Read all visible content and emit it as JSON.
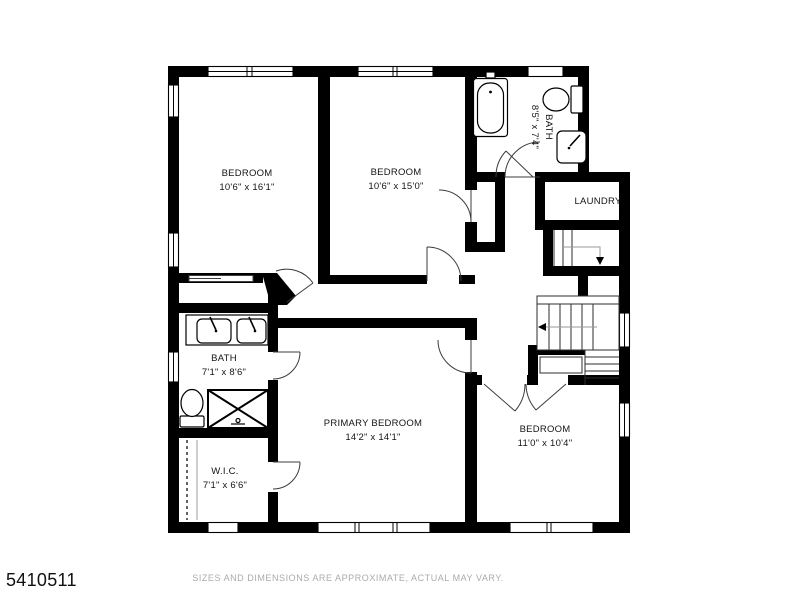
{
  "meta": {
    "listing_id": "5410511",
    "disclaimer": "SIZES AND DIMENSIONS ARE APPROXIMATE, ACTUAL MAY VARY."
  },
  "rooms": [
    {
      "name": "BEDROOM",
      "dims": "10'6\" x 16'1\""
    },
    {
      "name": "BEDROOM",
      "dims": "10'6\" x 15'0\""
    },
    {
      "name": "BATH",
      "dims": "8'5\" x 7'4\""
    },
    {
      "name": "LAUNDRY",
      "dims": ""
    },
    {
      "name": "BATH",
      "dims": "7'1\" x 8'6\""
    },
    {
      "name": "W.I.C.",
      "dims": "7'1\" x 6'6\""
    },
    {
      "name": "PRIMARY BEDROOM",
      "dims": "14'2\" x 14'1\""
    },
    {
      "name": "BEDROOM",
      "dims": "11'0\" x 10'4\""
    }
  ]
}
